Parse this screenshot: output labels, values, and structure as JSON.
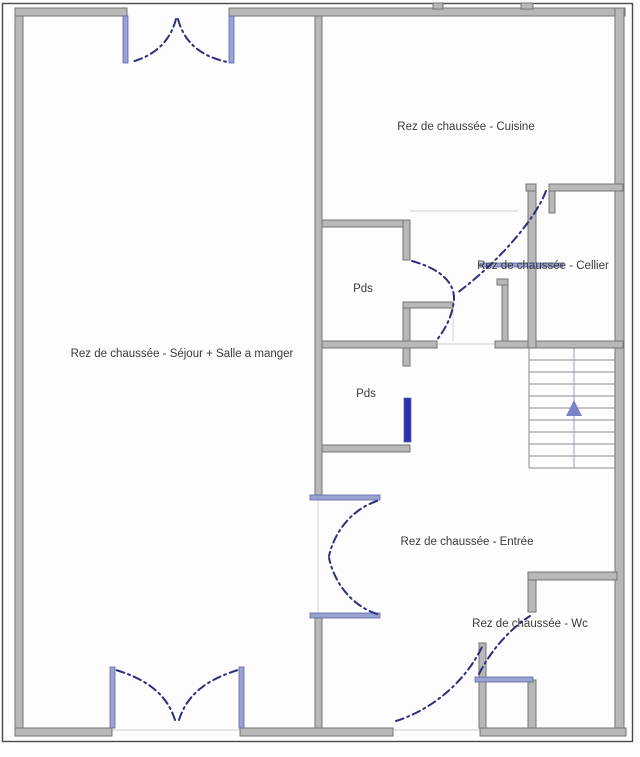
{
  "plan": {
    "title": "Rez de chaussée floor plan",
    "colors": {
      "background": "#fdfdfd",
      "wall_fill": "#b8b8b8",
      "wall_edge": "#757575",
      "outline": "#4a4a4a",
      "door_fill": "#9aa3cf",
      "door_edge": "#5b66a8",
      "door_dark": "#2d2db0",
      "arc": "#2e2e7e",
      "stair_line": "#8a8a8a",
      "thin_line": "#d9d9d9",
      "arrow": "#7b84c4",
      "text": "#3a3a3a"
    },
    "outline_rect": {
      "x": 2.5,
      "y": 3.5,
      "w": 630,
      "h": 738
    },
    "walls": [
      {
        "id": "wall-left",
        "x": 15,
        "y": 8,
        "w": 8,
        "h": 728
      },
      {
        "id": "wall-top-left",
        "x": 15,
        "y": 8,
        "w": 112,
        "h": 8
      },
      {
        "id": "wall-top-right",
        "x": 229,
        "y": 8,
        "w": 396,
        "h": 8
      },
      {
        "id": "wall-right",
        "x": 615,
        "y": 8,
        "w": 9,
        "h": 728
      },
      {
        "id": "wall-bottom-a",
        "x": 15,
        "y": 728,
        "w": 97,
        "h": 8
      },
      {
        "id": "wall-bottom-b",
        "x": 240,
        "y": 728,
        "w": 153,
        "h": 8
      },
      {
        "id": "wall-bottom-c",
        "x": 480,
        "y": 728,
        "w": 146,
        "h": 8
      },
      {
        "id": "wall-mid-upper",
        "x": 315,
        "y": 16,
        "w": 7,
        "h": 479
      },
      {
        "id": "wall-mid-lower",
        "x": 315,
        "y": 617,
        "w": 7,
        "h": 111
      },
      {
        "id": "wall-pds1-top",
        "x": 322,
        "y": 220,
        "w": 88,
        "h": 7
      },
      {
        "id": "wall-pds1-right-upper",
        "x": 403,
        "y": 220,
        "w": 7,
        "h": 40
      },
      {
        "id": "wall-hall-partition-h",
        "x": 403,
        "y": 302,
        "w": 50,
        "h": 6
      },
      {
        "id": "wall-pds1-right-lower",
        "x": 403,
        "y": 308,
        "w": 7,
        "h": 36
      },
      {
        "id": "wall-pds1-bottom",
        "x": 322,
        "y": 341,
        "w": 115,
        "h": 7
      },
      {
        "id": "wall-main-h-right",
        "x": 495,
        "y": 341,
        "w": 128,
        "h": 7
      },
      {
        "id": "wall-pds2-right-stub",
        "x": 403,
        "y": 348,
        "w": 7,
        "h": 18
      },
      {
        "id": "wall-pds2-bottom",
        "x": 322,
        "y": 445,
        "w": 88,
        "h": 7
      },
      {
        "id": "wall-cellier-top-small",
        "x": 526,
        "y": 184,
        "w": 10,
        "h": 7
      },
      {
        "id": "wall-cellier-top",
        "x": 549,
        "y": 184,
        "w": 74,
        "h": 7
      },
      {
        "id": "wall-cellier-jamb",
        "x": 549,
        "y": 191,
        "w": 6,
        "h": 22
      },
      {
        "id": "wall-cellier-left",
        "x": 528,
        "y": 191,
        "w": 8,
        "h": 157
      },
      {
        "id": "wall-shaft",
        "x": 502,
        "y": 280,
        "w": 6,
        "h": 61
      },
      {
        "id": "wall-shaft-stub",
        "x": 497,
        "y": 279,
        "w": 11,
        "h": 6
      },
      {
        "id": "wall-wc-top",
        "x": 528,
        "y": 572,
        "w": 89,
        "h": 8
      },
      {
        "id": "wall-wc-left-upper",
        "x": 528,
        "y": 580,
        "w": 8,
        "h": 32
      },
      {
        "id": "wall-wc-left-lower",
        "x": 528,
        "y": 680,
        "w": 8,
        "h": 48
      },
      {
        "id": "wall-nook",
        "x": 479,
        "y": 643,
        "w": 7,
        "h": 85
      },
      {
        "id": "wall-tab-a",
        "x": 433,
        "y": 3,
        "w": 10,
        "h": 6
      },
      {
        "id": "wall-tab-b",
        "x": 521,
        "y": 3,
        "w": 12,
        "h": 6
      }
    ],
    "door_leaves": [
      {
        "id": "door-jamb-top-left",
        "x": 123,
        "y": 16,
        "w": 5,
        "h": 47
      },
      {
        "id": "door-jamb-top-right",
        "x": 229,
        "y": 16,
        "w": 5,
        "h": 47
      },
      {
        "id": "door-jamb-bottom-left",
        "x": 110,
        "y": 667,
        "w": 5,
        "h": 61
      },
      {
        "id": "door-jamb-bottom-right",
        "x": 239,
        "y": 667,
        "w": 5,
        "h": 61
      },
      {
        "id": "door-sejour-upper",
        "x": 310,
        "y": 495,
        "w": 70,
        "h": 5
      },
      {
        "id": "door-sejour-lower",
        "x": 310,
        "y": 613,
        "w": 70,
        "h": 5
      },
      {
        "id": "door-pds2-leaf",
        "x": 404,
        "y": 398,
        "w": 7,
        "h": 44,
        "dark": true
      },
      {
        "id": "door-wc-leaf",
        "x": 475,
        "y": 677,
        "w": 58,
        "h": 5
      },
      {
        "id": "door-cellier-leaf",
        "x": 480,
        "y": 263,
        "w": 83,
        "h": 4
      }
    ],
    "swing_arcs": [
      {
        "id": "arc-top-door-left",
        "d": "M 176,19 C 170,42 154,56 131,62"
      },
      {
        "id": "arc-top-door-right",
        "d": "M 178,19 C 184,42 200,56 227,62"
      },
      {
        "id": "arc-bottom-door-left",
        "d": "M 175,720 C 168,698 152,681 116,670"
      },
      {
        "id": "arc-bottom-door-right",
        "d": "M 179,720 C 186,698 202,681 238,670"
      },
      {
        "id": "arc-sejour-upper",
        "d": "M 377,501 C 353,509 335,530 329,556"
      },
      {
        "id": "arc-sejour-lower",
        "d": "M 377,614 C 353,606 335,585 329,558"
      },
      {
        "id": "arc-front-door",
        "d": "M 396,721 C 425,712 462,688 482,647"
      },
      {
        "id": "arc-pds1-door",
        "d": "M 412,261 C 441,269 455,283 454,300 C 452,319 443,332 436,341"
      },
      {
        "id": "arc-cellier-door",
        "d": "M 546,191 C 536,218 499,262 457,293"
      },
      {
        "id": "arc-wc-door",
        "d": "M 479,674 C 491,650 510,629 530,616"
      }
    ],
    "thin_lines": [
      {
        "id": "threshold-bottom-door",
        "x1": 112,
        "y1": 730,
        "x2": 240,
        "y2": 730
      },
      {
        "id": "threshold-front-door",
        "x1": 393,
        "y1": 730,
        "x2": 480,
        "y2": 730
      },
      {
        "id": "threshold-sejour-door",
        "x1": 318,
        "y1": 500,
        "x2": 318,
        "y2": 613
      },
      {
        "id": "threshold-hall",
        "x1": 437,
        "y1": 344,
        "x2": 495,
        "y2": 344
      },
      {
        "id": "boundary-kitchen-hall",
        "x1": 410,
        "y1": 211,
        "x2": 518,
        "y2": 211
      },
      {
        "id": "boundary-partition",
        "x1": 453,
        "y1": 308,
        "x2": 453,
        "y2": 341
      }
    ],
    "stairs": {
      "x": 529,
      "top": 348,
      "bottom": 468,
      "right": 615,
      "tread_ys": [
        360,
        372,
        384,
        396,
        408,
        420,
        432,
        444,
        456,
        468
      ],
      "center_x": 574,
      "arrow_points": "574,400 566,416 582,416"
    },
    "labels": [
      {
        "id": "cuisine",
        "text": "Rez de chaussée - Cuisine",
        "x": 466,
        "y": 130
      },
      {
        "id": "cellier",
        "text": "Rez de chaussée - Cellier",
        "x": 543,
        "y": 269
      },
      {
        "id": "sejour",
        "text": "Rez de chaussée - Séjour + Salle a manger",
        "x": 182,
        "y": 357
      },
      {
        "id": "pds1",
        "text": "Pds",
        "x": 363,
        "y": 292
      },
      {
        "id": "pds2",
        "text": "Pds",
        "x": 366,
        "y": 397
      },
      {
        "id": "entree",
        "text": "Rez de chaussée - Entrée",
        "x": 467,
        "y": 545
      },
      {
        "id": "wc",
        "text": "Rez de chaussée - Wc",
        "x": 530,
        "y": 627
      }
    ],
    "label_font_px": 11.5
  }
}
